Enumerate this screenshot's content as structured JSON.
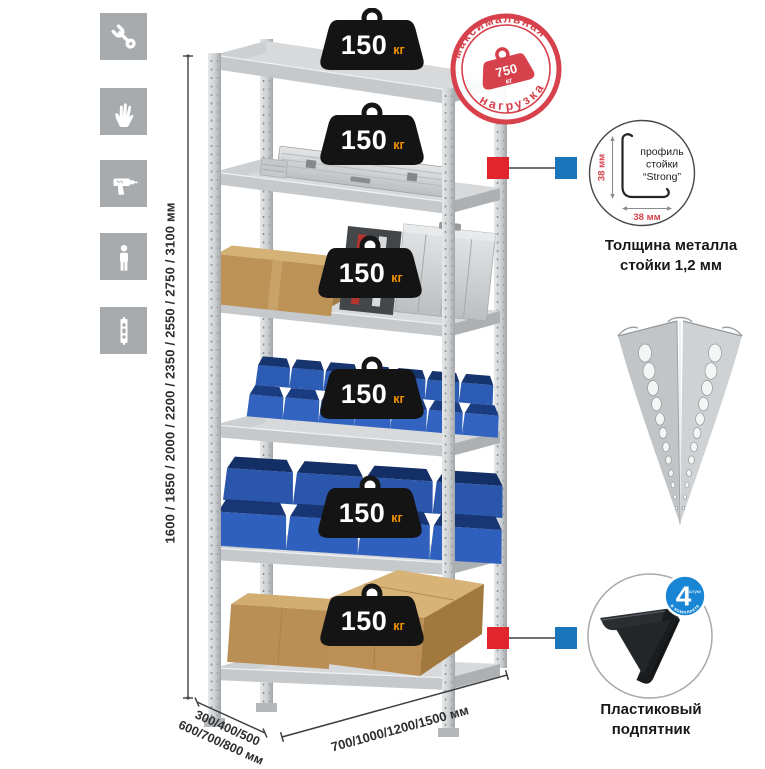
{
  "left_icons": {
    "items": [
      {
        "icon": "wrench-icon"
      },
      {
        "icon": "work-gloves-icon"
      },
      {
        "icon": "drill-icon"
      },
      {
        "icon": "person-icon"
      },
      {
        "icon": "perforated-post-icon"
      }
    ]
  },
  "dimensions": {
    "heights_label": "1600 / 1850 / 2000 / 2200 / 2350 / 2550 / 2750 / 3100 мм",
    "depth_line1": "300/400/500",
    "depth_line2": "600/700/800 мм",
    "width_label": "700/1000/1200/1500 мм"
  },
  "rack": {
    "shelves": [
      {
        "load": "150",
        "unit": "кг"
      },
      {
        "load": "150",
        "unit": "кг"
      },
      {
        "load": "150",
        "unit": "кг"
      },
      {
        "load": "150",
        "unit": "кг"
      },
      {
        "load": "150",
        "unit": "кг"
      },
      {
        "load": "150",
        "unit": "кг"
      }
    ]
  },
  "max_load_stamp": {
    "arc_top": "максимальная",
    "arc_bottom": "нагрузка",
    "value": "750",
    "unit": "кг"
  },
  "profile_detail": {
    "dim_vertical": "38 мм",
    "dim_horizontal": "38 мм",
    "label_line1": "профиль",
    "label_line2": "стойки",
    "label_line3": "“Strong”",
    "caption_line1": "Толщина металла",
    "caption_line2": "стойки 1,2 мм"
  },
  "foot_detail": {
    "badge_value": "4",
    "badge_small": "штуки",
    "badge_arc": "в комплекте",
    "caption_line1": "Пластиковый",
    "caption_line2": "подпятник"
  },
  "colors": {
    "accent_red": "#d6414b",
    "accent_blue": "#1b75bb",
    "badge_black": "#141414",
    "unit_orange": "#f29200",
    "bin_blue": "#2c5cb4"
  }
}
